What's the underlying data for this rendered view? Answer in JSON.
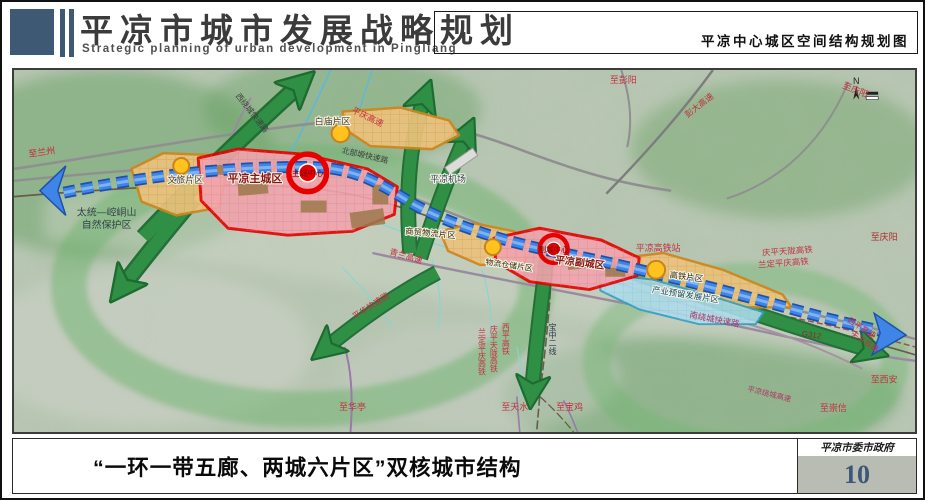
{
  "header": {
    "title": "平凉市城市发展战略规划",
    "subtitle_en": "Strategic planning of urban development in Pingliang",
    "map_caption": "平凉中心城区空间结构规划图"
  },
  "footer": {
    "caption": "“一环一带五廊、两城六片区”双核城市结构",
    "agency": "平凉市委市政府",
    "page_number": "10"
  },
  "map": {
    "compass_label": "N",
    "colors": {
      "core_red": "#e60000",
      "corridor_green": "#2f8f45",
      "belt_blue": "#3f85e8",
      "district_orange": "#ecc27c",
      "reserve_blue": "#aedcec"
    },
    "labels": {
      "to_lanzhou": "至兰州",
      "nature_reserve_1": "太统—崆峒山",
      "nature_reserve_2": "自然保护区",
      "wenlv_district": "文旅片区",
      "main_city": "平凉主城区",
      "main_city_center": "主城中心",
      "west_ring_road": "西绕城快速路",
      "baimiao_district": "白庙片区",
      "pingqing_expressway": "平庆高速",
      "north_plateau_road": "北部塬快速路",
      "airport": "平凉机场",
      "to_pengyang": "至彭阳",
      "pengda_expressway": "彭大高速",
      "to_qingyang_ne": "至庆阳",
      "qinglan_expressway": "青兰高速",
      "trade_logistics_district": "商贸物流片区",
      "logistics_storage_district": "物流仓储片区",
      "sub_city": "平凉副城区",
      "sub_city_center": "副城中心",
      "hsr_station": "平凉高铁站",
      "hsr_district": "高铁片区",
      "industry_reserve_district": "产业预留发展片区",
      "south_ring_road": "南绕城快速路",
      "qingping_tianlong_hsr": "庆平天陇高铁",
      "landing_pingqing_hsr": "兰定平庆高铁",
      "to_qingyang_e": "至庆阳",
      "g312": "G312",
      "xiping_expressway": "西平高速",
      "tianping_railway": "天平铁路",
      "to_xian": "至西安",
      "to_chongxin": "至崇信",
      "ring_expressway": "平凉绕城高速",
      "pinghua_road": "平华快速路",
      "to_huating": "至华亭",
      "to_tianshui": "至天水",
      "to_baoji": "至宝鸡",
      "baozhong_line2": "宝中二线",
      "xiping_hsr": "西平高铁",
      "qingping_tianlong_hsr_v": "庆平天陇高铁",
      "landing_pingqing_hsr_v": "兰定平庆高铁"
    }
  }
}
